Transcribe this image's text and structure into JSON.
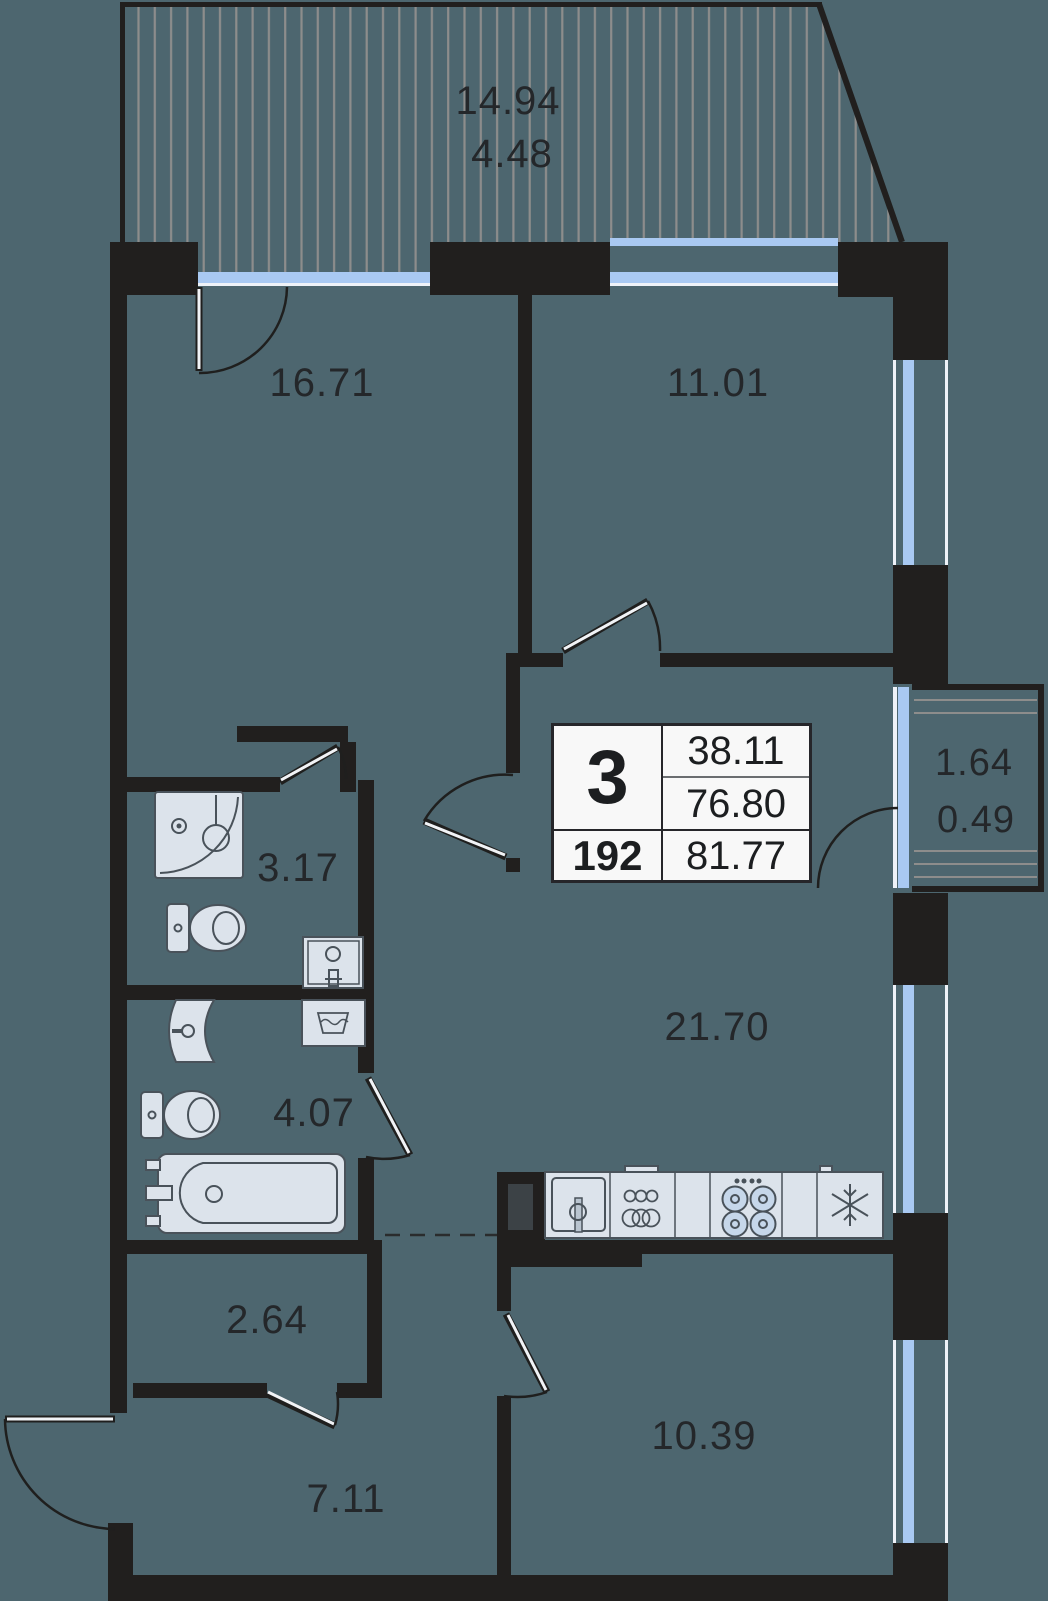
{
  "labels": {
    "terrace": {
      "line1": "14.94",
      "line2": "4.48"
    },
    "balcony": {
      "line1": "1.64",
      "line2": "0.49"
    },
    "rooms": [
      {
        "name": "bedroom-large",
        "area": "16.71"
      },
      {
        "name": "bedroom-small",
        "area": "11.01"
      },
      {
        "name": "bathroom-shower",
        "area": "3.17"
      },
      {
        "name": "bathroom-tub",
        "area": "4.07"
      },
      {
        "name": "storage",
        "area": "2.64"
      },
      {
        "name": "living-kitchen",
        "area": "21.70"
      },
      {
        "name": "room-bottom",
        "area": "10.39"
      },
      {
        "name": "hallway",
        "area": "7.11"
      }
    ]
  },
  "info_box": {
    "room_count": "3",
    "area_1": "38.11",
    "area_2": "76.80",
    "unit_number": "192",
    "area_total": "81.77"
  },
  "colors": {
    "background": "#4d666f",
    "walls": "#211f1e",
    "glazing": "#a9c9f2",
    "glazing_frame": "#eef2f8",
    "hatch": "#8d8d8c",
    "fixture_fill": "#dce3eb",
    "fixture_stroke": "#49525a",
    "info_box_bg": "#f8f8f8",
    "text": "#24272a"
  },
  "fixtures": [
    "shower-icon",
    "toilet-icon",
    "vanity-sink-icon",
    "wall-sink-icon",
    "washing-machine-icon",
    "bathtub-icon",
    "kitchen-sink-icon",
    "oven-icon",
    "stove-icon",
    "fridge-icon",
    "snowflake-icon"
  ]
}
